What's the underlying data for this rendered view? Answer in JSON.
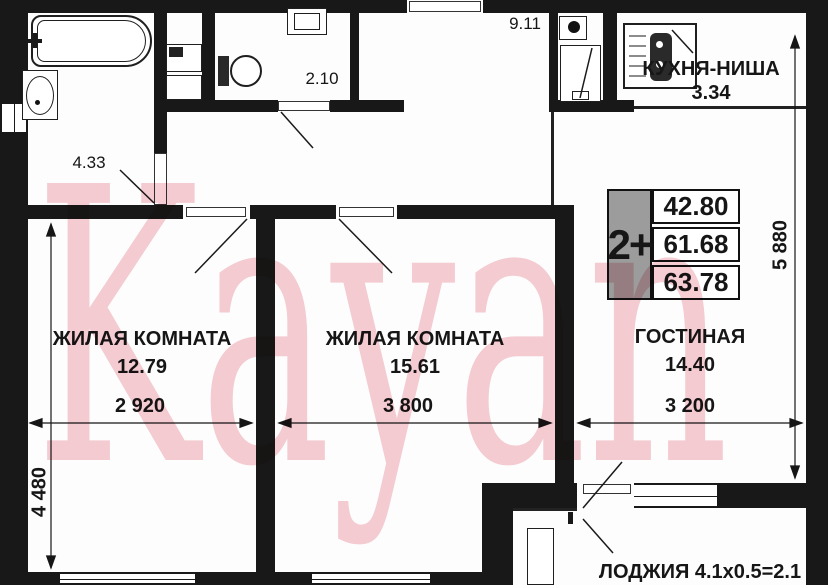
{
  "watermark": {
    "text": "Kayan",
    "color": "#f5cdd3"
  },
  "rooms": {
    "bedroom1": {
      "label": "ЖИЛАЯ КОМНАТА",
      "area": "12.79"
    },
    "bedroom2": {
      "label": "ЖИЛАЯ КОМНАТА",
      "area": "15.61"
    },
    "living": {
      "label": "ГОСТИНАЯ",
      "area": "14.40"
    },
    "kitchen": {
      "label": "КУХНЯ-НИША",
      "area": "3.34"
    },
    "hall": {
      "area": "9.11"
    },
    "wc": {
      "area": "2.10"
    },
    "bathroom": {
      "area": "4.33"
    },
    "loggia": {
      "label": "ЛОДЖИЯ 4.1х0.5=2.1"
    }
  },
  "info_table": {
    "type": "2+",
    "values": [
      "42.80",
      "61.68",
      "63.78"
    ],
    "accent_gray": "#9c9c9c"
  },
  "dimensions": {
    "bedroom1_width": "2 920",
    "bedroom2_width": "3 800",
    "living_width": "3 200",
    "left_height": "4 480",
    "right_height": "5 880"
  },
  "icons": {
    "bathtub": "bathtub-icon",
    "sink": "sink-icon",
    "washer": "washer-icon",
    "toilet": "toilet-icon",
    "stove": "stove-icon",
    "vent_shaft": "vent-shaft-icon"
  },
  "wall_color": "#181818"
}
